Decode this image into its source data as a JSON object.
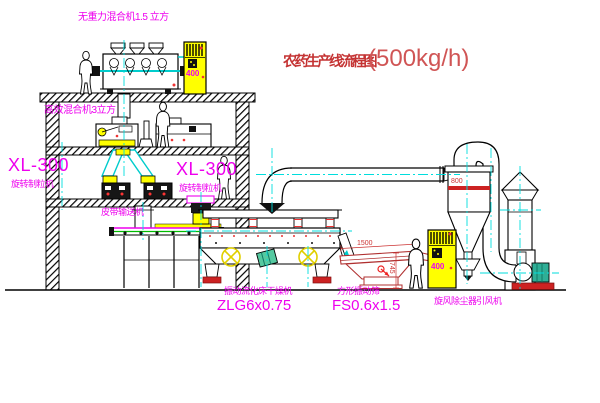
{
  "title": {
    "name": "农药生产线流程图",
    "capacity": "(500kg/h)"
  },
  "equipment_labels": {
    "gravity_mixer": "无重力混合机1.5 立方",
    "mixer_3m3": "高效混合机3立方",
    "granulator_left_model": "XL-300",
    "granulator_left_name": "旋转制粒机",
    "granulator_mid_model": "XL-300",
    "granulator_mid_name": "旋转制粒机",
    "belt_conveyor": "皮带输送机",
    "dryer_name": "振动流化床干燥机",
    "dryer_model": "ZLG6x0.75",
    "sieve_name": "方形振动筛",
    "sieve_model": "FS0.6x1.5",
    "cyclone": "旋风除尘器",
    "fan": "引风机"
  },
  "dimensions": {
    "sieve_length": "1500",
    "sieve_height": "745",
    "cyclone_diameter": "800"
  },
  "control_cabinets": {
    "upper_text": "400",
    "lower_text": "400"
  },
  "colors": {
    "label_magenta": "#ee00ee",
    "title_red": "#c43333",
    "capacity_red": "#d05555",
    "centerline_cyan": "#00dddd",
    "cabinet_yellow": "#ffff00",
    "sieve_red": "#b03030",
    "belt_green": "#00bb00",
    "foot_red": "#cc2222"
  }
}
